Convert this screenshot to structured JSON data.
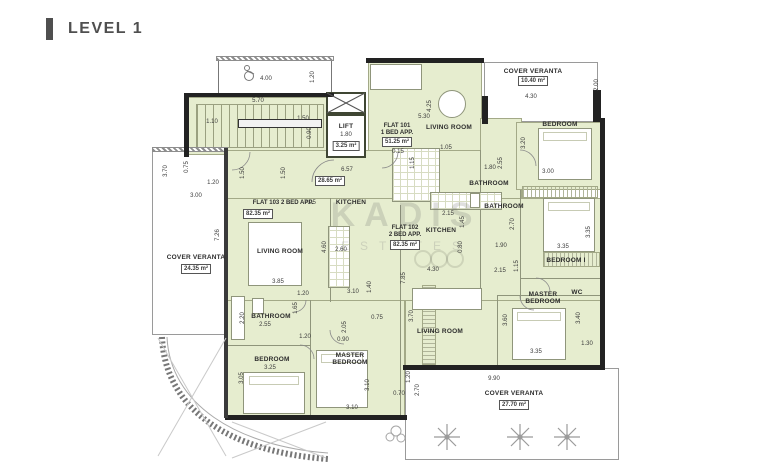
{
  "header": {
    "title": "LEVEL 1"
  },
  "watermark": {
    "line1": "KADIS",
    "line2": "ESTATES"
  },
  "colors": {
    "room_fill": "#e6edcf",
    "wall_dark": "#222222",
    "olive_wall": "#3f4633",
    "accent_bar": "#4f4f4f",
    "header_text": "#4f4f4f",
    "dim_text": "#3c3c3c"
  },
  "plan": {
    "labels": [
      {
        "t": "4.00",
        "x": 266,
        "y": 79,
        "k": "d"
      },
      {
        "t": "1.20",
        "x": 313,
        "y": 77,
        "k": "v"
      },
      {
        "t": "5.70",
        "x": 258,
        "y": 101,
        "k": "d"
      },
      {
        "t": "1.10",
        "x": 212,
        "y": 122,
        "k": "d"
      },
      {
        "t": "1.50",
        "x": 303,
        "y": 119,
        "k": "d"
      },
      {
        "t": "0.90",
        "x": 310,
        "y": 133,
        "k": "v"
      },
      {
        "t": "0.75",
        "x": 187,
        "y": 167,
        "k": "v"
      },
      {
        "t": "3.70",
        "x": 166,
        "y": 171,
        "k": "v"
      },
      {
        "t": "1.50",
        "x": 243,
        "y": 173,
        "k": "v"
      },
      {
        "t": "1.50",
        "x": 284,
        "y": 173,
        "k": "v"
      },
      {
        "t": "LIFT",
        "x": 346,
        "y": 127,
        "k": "r"
      },
      {
        "t": "1.80",
        "x": 346,
        "y": 135,
        "k": "d"
      },
      {
        "t": "3.25 m²",
        "x": 346,
        "y": 146,
        "k": "a"
      },
      {
        "t": "6.57",
        "x": 347,
        "y": 170,
        "k": "d"
      },
      {
        "t": "28.65 m²",
        "x": 330,
        "y": 181,
        "k": "a"
      },
      {
        "t": "FLAT 101",
        "x": 397,
        "y": 126,
        "k": "f"
      },
      {
        "t": "1 BED APP.",
        "x": 397,
        "y": 133,
        "k": "f"
      },
      {
        "t": "51.25 m²",
        "x": 397,
        "y": 142,
        "k": "a"
      },
      {
        "t": "0.15",
        "x": 398,
        "y": 152,
        "k": "d"
      },
      {
        "t": "5.30",
        "x": 424,
        "y": 117,
        "k": "d"
      },
      {
        "t": "4.25",
        "x": 430,
        "y": 106,
        "k": "v"
      },
      {
        "t": "LIVING ROOM",
        "x": 449,
        "y": 128,
        "k": "r"
      },
      {
        "t": "COVER VERANTA",
        "x": 533,
        "y": 72,
        "k": "r"
      },
      {
        "t": "10.40 m²",
        "x": 533,
        "y": 81,
        "k": "a"
      },
      {
        "t": "4.30",
        "x": 531,
        "y": 97,
        "k": "d"
      },
      {
        "t": "2.00",
        "x": 597,
        "y": 85,
        "k": "v"
      },
      {
        "t": "BEDROOM",
        "x": 560,
        "y": 125,
        "k": "r"
      },
      {
        "t": "3.20",
        "x": 524,
        "y": 143,
        "k": "v"
      },
      {
        "t": "3.00",
        "x": 548,
        "y": 172,
        "k": "d"
      },
      {
        "t": "1.05",
        "x": 446,
        "y": 148,
        "k": "d"
      },
      {
        "t": "1.15",
        "x": 413,
        "y": 163,
        "k": "v"
      },
      {
        "t": "1.80",
        "x": 490,
        "y": 168,
        "k": "d"
      },
      {
        "t": "2.55",
        "x": 501,
        "y": 163,
        "k": "v"
      },
      {
        "t": "BATHROOM",
        "x": 489,
        "y": 184,
        "k": "r"
      },
      {
        "t": "BATHROOM",
        "x": 504,
        "y": 207,
        "k": "r"
      },
      {
        "t": "2.70",
        "x": 513,
        "y": 224,
        "k": "v"
      },
      {
        "t": "1.90",
        "x": 501,
        "y": 246,
        "k": "d"
      },
      {
        "t": "3.35",
        "x": 563,
        "y": 247,
        "k": "d"
      },
      {
        "t": "3.35",
        "x": 589,
        "y": 232,
        "k": "v"
      },
      {
        "t": "BEDROOM I",
        "x": 566,
        "y": 261,
        "k": "r"
      },
      {
        "t": "2.15",
        "x": 500,
        "y": 271,
        "k": "d"
      },
      {
        "t": "1.15",
        "x": 517,
        "y": 266,
        "k": "v"
      },
      {
        "t": "MASTER",
        "x": 543,
        "y": 295,
        "k": "r"
      },
      {
        "t": "BEDROOM",
        "x": 543,
        "y": 302,
        "k": "r"
      },
      {
        "t": "WC",
        "x": 577,
        "y": 293,
        "k": "r"
      },
      {
        "t": "3.60",
        "x": 506,
        "y": 320,
        "k": "v"
      },
      {
        "t": "3.40",
        "x": 579,
        "y": 318,
        "k": "v"
      },
      {
        "t": "3.35",
        "x": 536,
        "y": 352,
        "k": "d"
      },
      {
        "t": "1.30",
        "x": 587,
        "y": 344,
        "k": "d"
      },
      {
        "t": "LIVING ROOM",
        "x": 440,
        "y": 332,
        "k": "r"
      },
      {
        "t": "3.70",
        "x": 412,
        "y": 316,
        "k": "v"
      },
      {
        "t": "4.30",
        "x": 433,
        "y": 270,
        "k": "d"
      },
      {
        "t": "7.85",
        "x": 404,
        "y": 278,
        "k": "v"
      },
      {
        "t": "KITCHEN",
        "x": 441,
        "y": 231,
        "k": "r"
      },
      {
        "t": "2.15",
        "x": 448,
        "y": 214,
        "k": "d"
      },
      {
        "t": "1.45",
        "x": 463,
        "y": 222,
        "k": "v"
      },
      {
        "t": "0.80",
        "x": 461,
        "y": 247,
        "k": "v"
      },
      {
        "t": "FLAT 102",
        "x": 405,
        "y": 228,
        "k": "f"
      },
      {
        "t": "2 BED APP.",
        "x": 405,
        "y": 235,
        "k": "f"
      },
      {
        "t": "82.35 m²",
        "x": 405,
        "y": 245,
        "k": "a"
      },
      {
        "t": "FLAT 103 2 BED APP.",
        "x": 283,
        "y": 203,
        "k": "f"
      },
      {
        "t": "82.35 m²",
        "x": 258,
        "y": 214,
        "k": "a"
      },
      {
        "t": "7.05",
        "x": 310,
        "y": 203,
        "k": "d"
      },
      {
        "t": "KITCHEN",
        "x": 351,
        "y": 203,
        "k": "r"
      },
      {
        "t": "2.60",
        "x": 341,
        "y": 250,
        "k": "d"
      },
      {
        "t": "LIVING ROOM",
        "x": 280,
        "y": 252,
        "k": "r"
      },
      {
        "t": "4.60",
        "x": 325,
        "y": 247,
        "k": "v"
      },
      {
        "t": "3.85",
        "x": 278,
        "y": 282,
        "k": "d"
      },
      {
        "t": "1.20",
        "x": 303,
        "y": 294,
        "k": "d"
      },
      {
        "t": "3.10",
        "x": 353,
        "y": 292,
        "k": "d"
      },
      {
        "t": "1.40",
        "x": 370,
        "y": 287,
        "k": "v"
      },
      {
        "t": "1.20",
        "x": 213,
        "y": 183,
        "k": "d"
      },
      {
        "t": "3.00",
        "x": 196,
        "y": 196,
        "k": "d"
      },
      {
        "t": "7.26",
        "x": 218,
        "y": 235,
        "k": "v"
      },
      {
        "t": "COVER VERANTA",
        "x": 196,
        "y": 258,
        "k": "r"
      },
      {
        "t": "24.35 m²",
        "x": 196,
        "y": 269,
        "k": "a"
      },
      {
        "t": "BATHROOM",
        "x": 271,
        "y": 317,
        "k": "r"
      },
      {
        "t": "2.20",
        "x": 243,
        "y": 318,
        "k": "v"
      },
      {
        "t": "2.55",
        "x": 265,
        "y": 325,
        "k": "d"
      },
      {
        "t": "1.65",
        "x": 296,
        "y": 308,
        "k": "v"
      },
      {
        "t": "1.20",
        "x": 305,
        "y": 337,
        "k": "d"
      },
      {
        "t": "0.90",
        "x": 343,
        "y": 340,
        "k": "d"
      },
      {
        "t": "2.05",
        "x": 345,
        "y": 327,
        "k": "v"
      },
      {
        "t": "0.75",
        "x": 377,
        "y": 318,
        "k": "d"
      },
      {
        "t": "BEDROOM",
        "x": 272,
        "y": 360,
        "k": "r"
      },
      {
        "t": "3.25",
        "x": 270,
        "y": 368,
        "k": "d"
      },
      {
        "t": "3.05",
        "x": 242,
        "y": 378,
        "k": "v"
      },
      {
        "t": "MASTER",
        "x": 350,
        "y": 356,
        "k": "r"
      },
      {
        "t": "BEDROOM",
        "x": 350,
        "y": 363,
        "k": "r"
      },
      {
        "t": "3.10",
        "x": 368,
        "y": 385,
        "k": "v"
      },
      {
        "t": "3.10",
        "x": 352,
        "y": 408,
        "k": "d"
      },
      {
        "t": "1.20",
        "x": 409,
        "y": 377,
        "k": "v"
      },
      {
        "t": "2.70",
        "x": 418,
        "y": 390,
        "k": "v"
      },
      {
        "t": "0.70",
        "x": 399,
        "y": 394,
        "k": "d"
      },
      {
        "t": "9.90",
        "x": 494,
        "y": 379,
        "k": "d"
      },
      {
        "t": "COVER VERANTA",
        "x": 514,
        "y": 394,
        "k": "r"
      },
      {
        "t": "27.70 m²",
        "x": 514,
        "y": 405,
        "k": "a"
      }
    ]
  }
}
